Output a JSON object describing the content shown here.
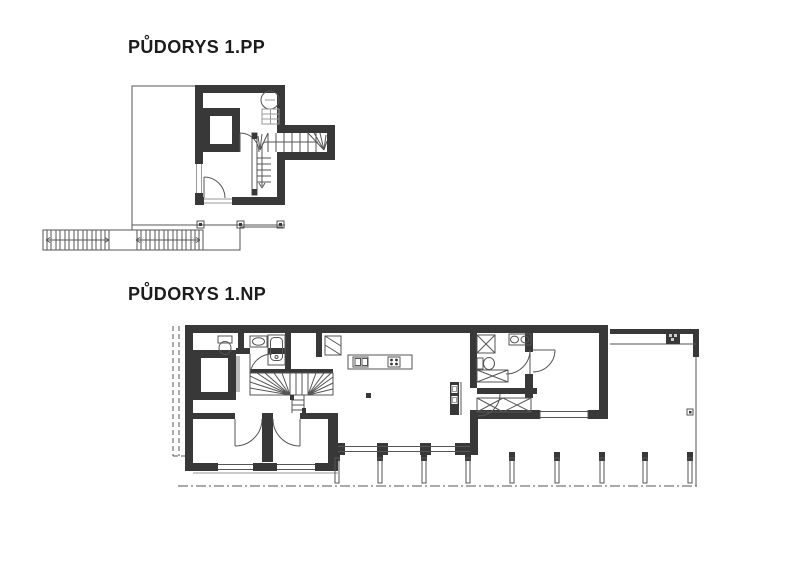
{
  "page": {
    "background": "#ffffff",
    "width": 800,
    "height": 565
  },
  "colors": {
    "paper": "#ffffff",
    "wall": "#383838",
    "line": "#555555",
    "lightline": "#9a9a9a",
    "text": "#1c1c1c"
  },
  "plans": {
    "pp": {
      "title": "PŮDORYS 1.PP",
      "symbols": [
        "site-outline",
        "exterior-stair-run",
        "fence-post",
        "storage-room",
        "boiler",
        "water-heater",
        "winder-staircase",
        "entry-door",
        "basement-window"
      ]
    },
    "np": {
      "title": "PŮDORYS 1.NP",
      "symbols": [
        "wc-toilet",
        "washbasin",
        "bathtub",
        "wardrobe",
        "winder-staircase",
        "kitchen-island",
        "kitchen-sink",
        "cooktop",
        "fireplace-column",
        "structural-column",
        "shower",
        "double-washbasin",
        "hall-wardrobe",
        "glass-facade",
        "terrace-post",
        "carport",
        "pergola-column",
        "site-boundary"
      ]
    }
  }
}
